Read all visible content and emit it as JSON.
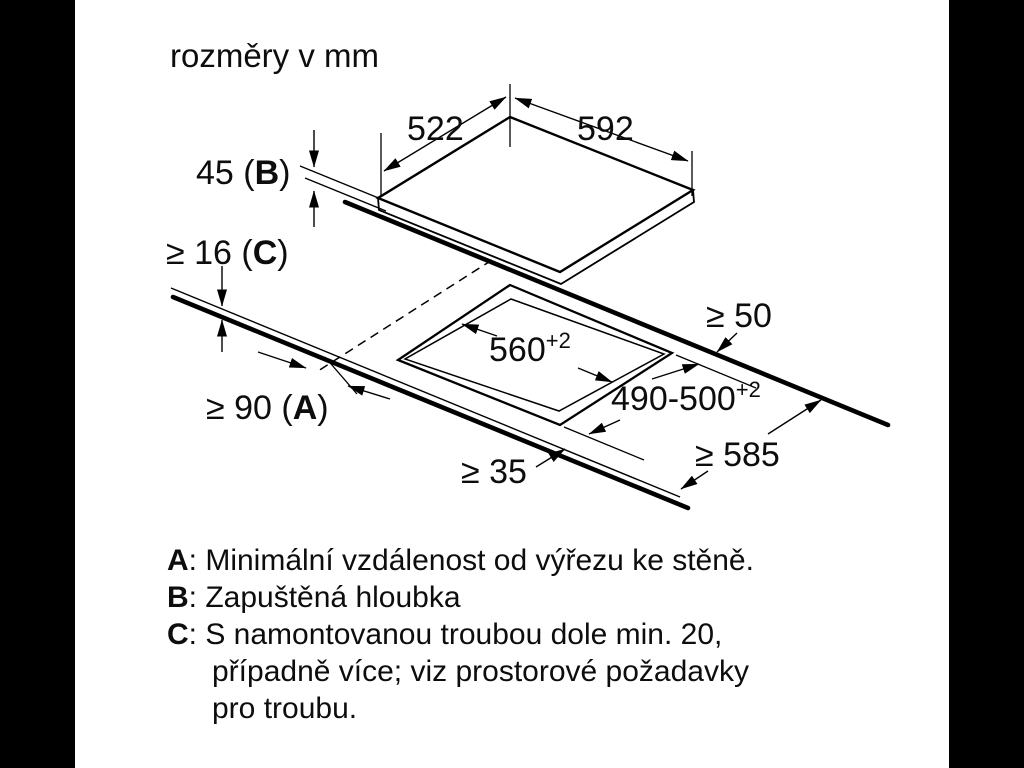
{
  "title": "rozměry v mm",
  "colors": {
    "line": "#000000",
    "text": "#0d0d0d",
    "background": "#ffffff",
    "letterbox": "#000000"
  },
  "dimensions": {
    "top_depth": "522",
    "top_width": "592",
    "recess_prefix": "45 (",
    "recess_letter": "B",
    "recess_suffix": ")",
    "thickness_prefix": "≥ 16 (",
    "thickness_letter": "C",
    "thickness_suffix": ")",
    "side_prefix": "≥ 90 (",
    "side_letter": "A",
    "side_suffix": ")",
    "rear_clearance": "≥ 50",
    "cutout_width": "560",
    "cutout_width_tol": "+2",
    "cutout_depth": "490-500",
    "cutout_depth_tol": "+2",
    "front_clearance": "≥ 35",
    "worktop_depth": "≥ 585"
  },
  "legend": {
    "rows": [
      {
        "letter": "A",
        "text": ": Minimální vzdálenost od výřezu ke stěně."
      },
      {
        "letter": "B",
        "text": ": Zapuštěná hloubka"
      },
      {
        "letter": "C",
        "text": ": S namontovanou troubou dole min. 20,"
      },
      {
        "letter": "",
        "text": "případně více; viz prostorové požadavky"
      },
      {
        "letter": "",
        "text": "pro troubu."
      }
    ]
  }
}
